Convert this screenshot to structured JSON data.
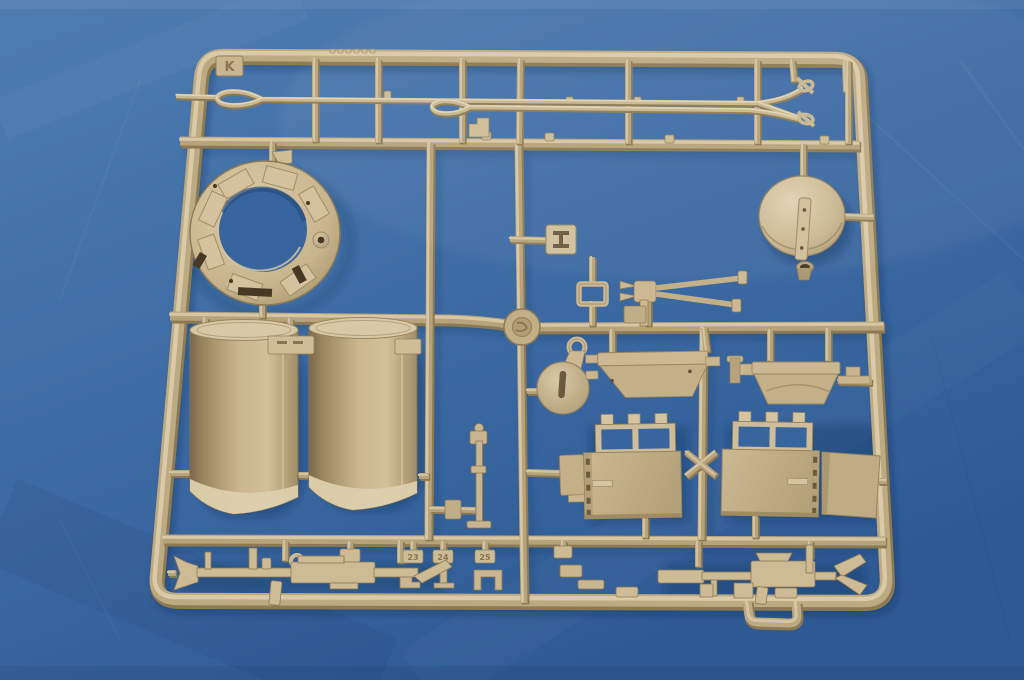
{
  "image": {
    "kind": "product-photo",
    "subject": "Tan injection-molded model kit sprue (parts tree) photographed on a blue leather-textured background"
  },
  "colors": {
    "bg_top": "#4e7db1",
    "bg_mid": "#3e6ca4",
    "bg_bottom": "#2e5a94",
    "hole_blue": "#38659e",
    "tan_hi": "#e3d5b5",
    "tan_light": "#d6c6a3",
    "tan_base": "#c4b18a",
    "tan_mid": "#b09c75",
    "tan_dark": "#94805c",
    "tan_deep": "#7b684a",
    "recess": "#463823",
    "emboss": "#8a7454",
    "shadow": "rgba(16,34,66,0.38)"
  },
  "sprue": {
    "letter_tab": "K",
    "part_number_tags": [
      "23",
      "24",
      "25"
    ],
    "parts": [
      "sprue-frame-with-runners",
      "tow-cable-with-loop-upper",
      "tow-cable-with-loop-lower",
      "turret-ring",
      "dome-cover-with-handle",
      "stowage-cylinder-half-left",
      "stowage-cylinder-half-right",
      "clamp-square-plate",
      "retainer-frame",
      "mg-pintle-mount",
      "pulley-bracket",
      "gun-cradle-bracket-left",
      "gun-cradle-bracket-right",
      "hatch-panel-left",
      "hatch-panel-right",
      "side-plate",
      "linkage-rod",
      "numbered-small-brackets",
      "machine-gun-left",
      "machine-gun-right"
    ]
  }
}
